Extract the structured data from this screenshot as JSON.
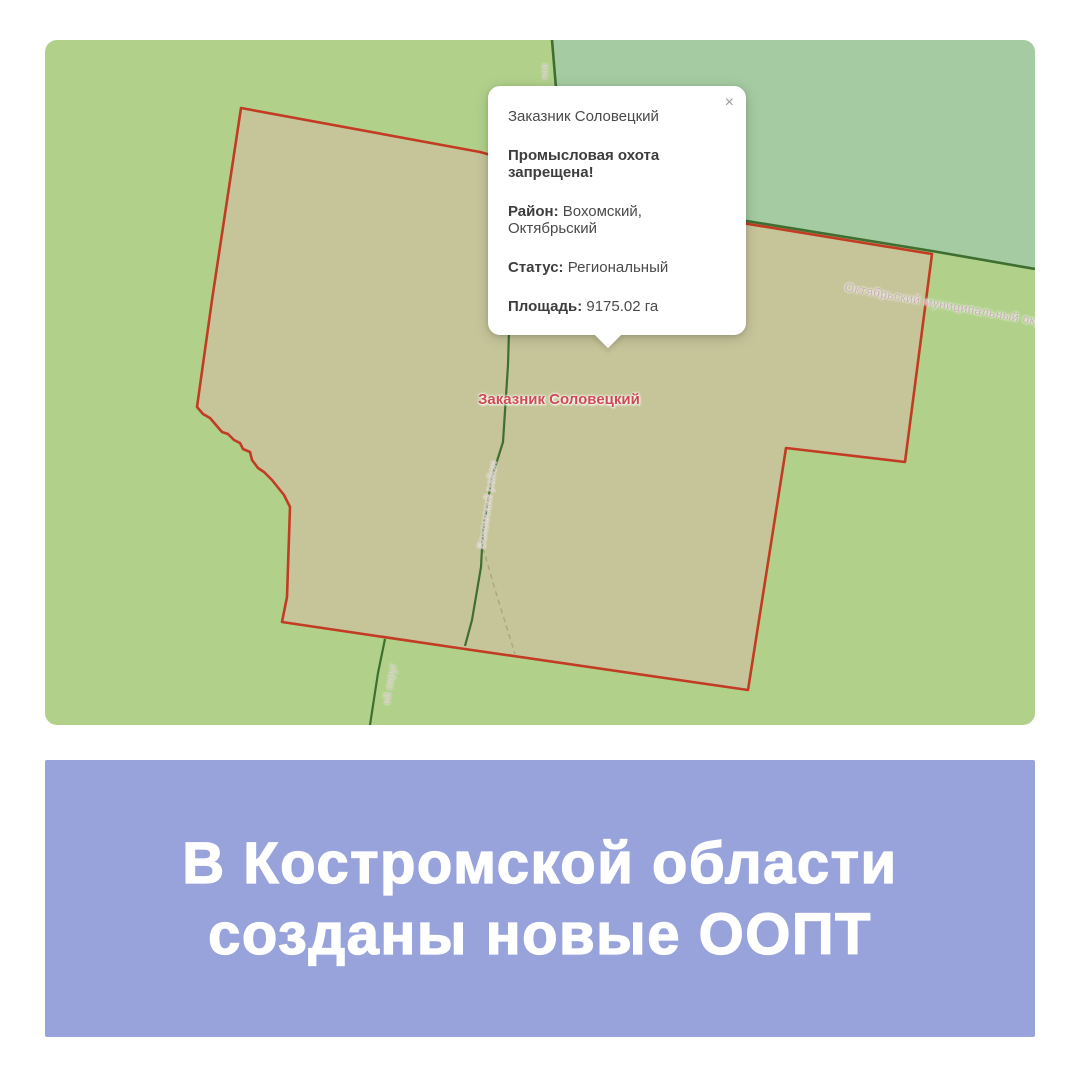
{
  "map": {
    "feature_label": "Заказник Соловецкий",
    "popup": {
      "title": "Заказник Соловецкий",
      "warning": "Промысловая охота запрещена!",
      "fields": [
        {
          "label": "Район:",
          "value": "Вохомский, Октябрьский"
        },
        {
          "label": "Статус:",
          "value": "Региональный"
        },
        {
          "label": "Площадь:",
          "value": "9175.02 га"
        }
      ],
      "close_glyph": "×"
    },
    "boundary_labels": {
      "okt_okrug": "Октябрьский муниципальный окр",
      "vohomsky_rayon": "Вохомский район",
      "okrug_fragment": "ий округ",
      "top_fragment": "нов"
    },
    "colors": {
      "base_green": "#b1d18b",
      "muted_green": "#a5cba2",
      "area_fill": "#c6c49b",
      "area_border": "#c23b22",
      "boundary_line": "#3e6f30",
      "feature_label_color": "#cf4a52"
    }
  },
  "banner": {
    "line1": "В Костромской области",
    "line2": "созданы новые ООПТ",
    "background": "#99a3db",
    "text_color": "#ffffff"
  }
}
